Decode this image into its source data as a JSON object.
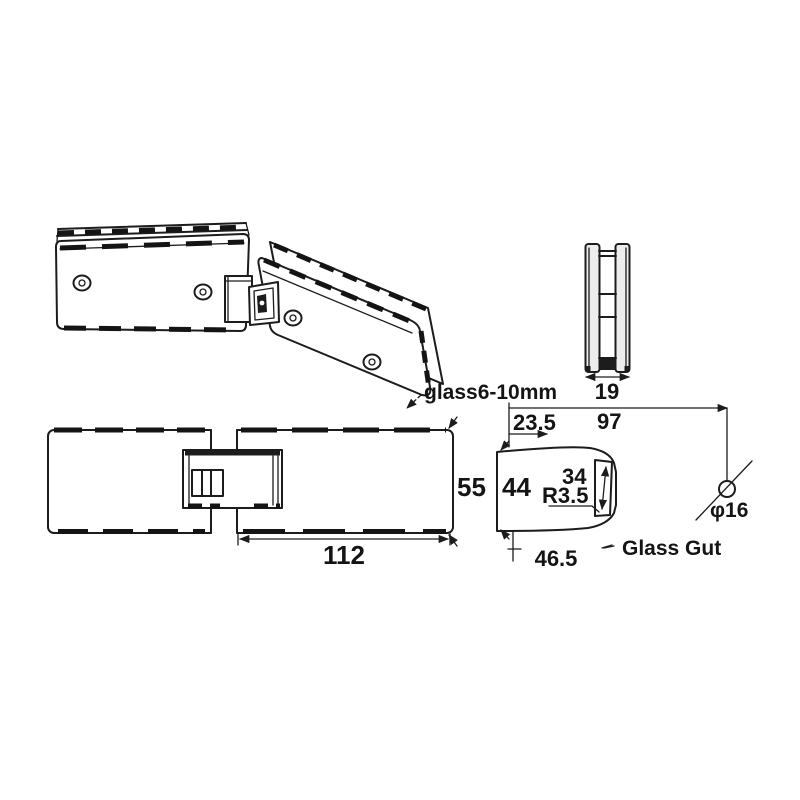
{
  "drawing": {
    "labels": {
      "glass_thickness": "glass6-10mm",
      "glass_cut": "Glass Gut",
      "hole_diameter": "φ16"
    },
    "dimensions": {
      "d19": "19",
      "d97": "97",
      "d23_5": "23.5",
      "d55": "55",
      "d44": "44",
      "d34": "34",
      "r3_5": "R3.5",
      "d112": "112",
      "d46_5": "46.5"
    },
    "colors": {
      "line": "#1c1c1c",
      "background": "#ffffff",
      "shade": "#ededed"
    }
  }
}
